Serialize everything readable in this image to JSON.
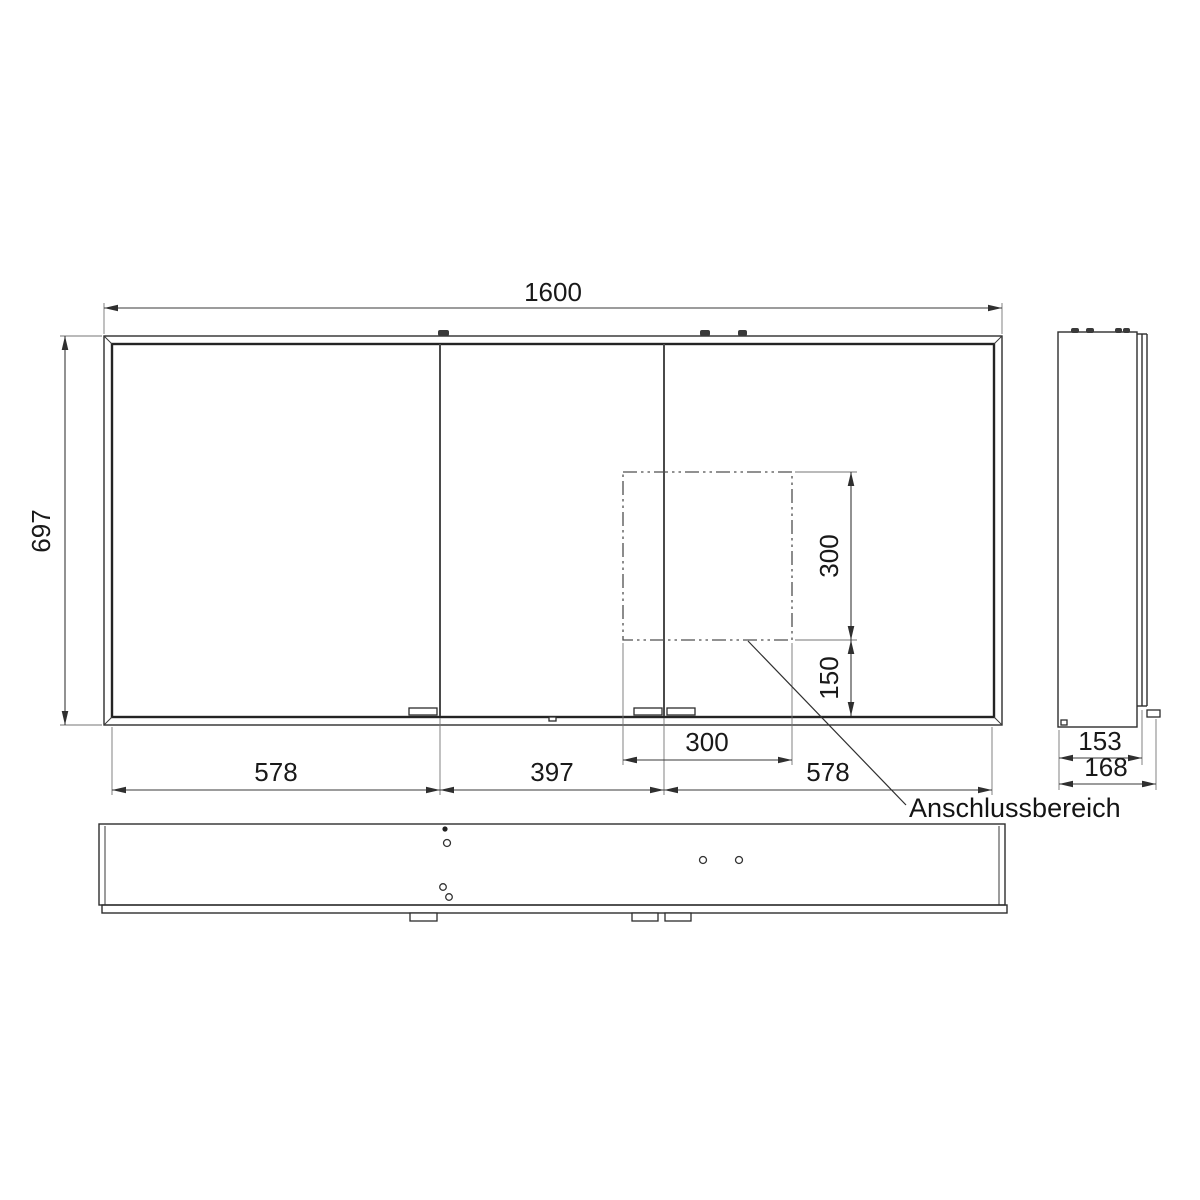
{
  "drawing": {
    "annotation": "Anschlussbereich",
    "front": {
      "overall_width_mm": "1600",
      "overall_height_mm": "697",
      "door_widths_mm": [
        "578",
        "397",
        "578"
      ],
      "connection_area": {
        "width_mm": "300",
        "height_mm": "300",
        "offset_from_bottom_mm": "150"
      }
    },
    "side": {
      "cabinet_depth_mm": "153",
      "overall_depth_mm": "168"
    }
  }
}
